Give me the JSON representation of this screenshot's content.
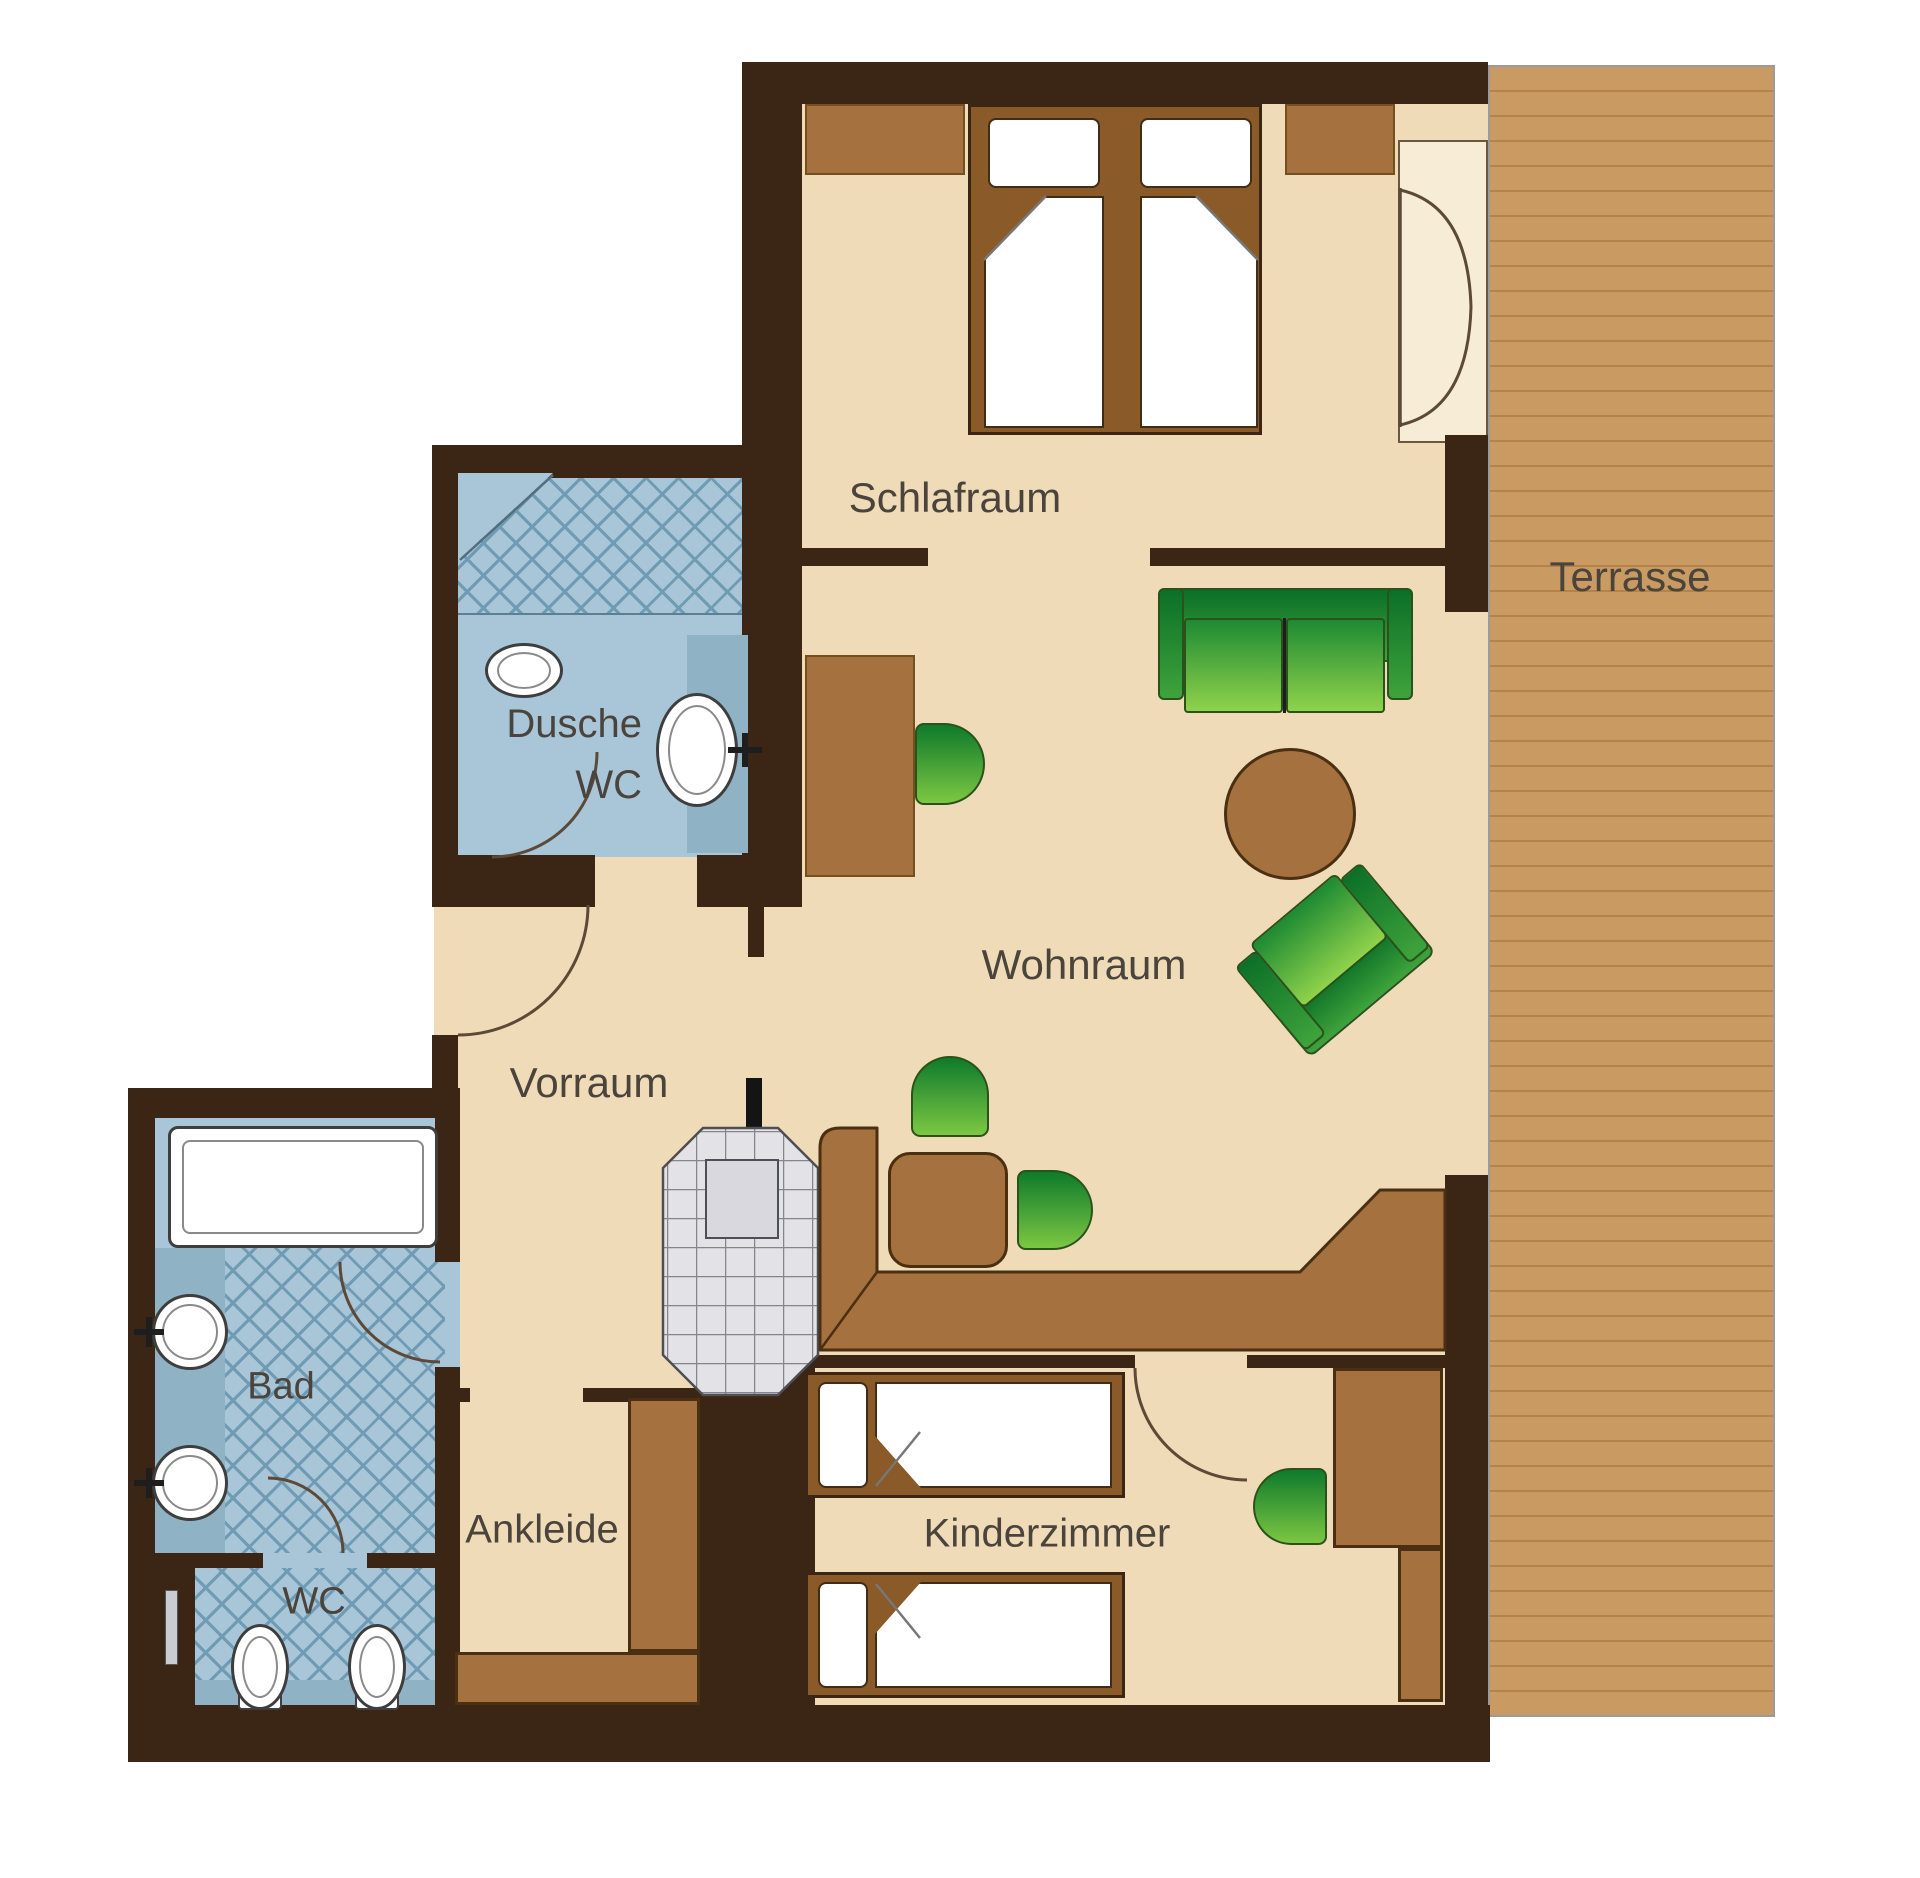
{
  "plan": {
    "type": "apartment-floor-plan",
    "labels": {
      "schlafraum": "Schlafraum",
      "terrasse": "Terrasse",
      "wohnraum": "Wohnraum",
      "vorraum": "Vorraum",
      "dusche": "Dusche",
      "dusche_wc": "WC",
      "bad": "Bad",
      "wc": "WC",
      "ankleide": "Ankleide",
      "kinderzimmer": "Kinderzimmer"
    },
    "colors": {
      "wall": "#3b2616",
      "floor": "#efdbb7",
      "floor_light": "#f7edd6",
      "terrace": "#c99b62",
      "terrace_line": "#b2834a",
      "tile": "#a9c6d8",
      "tile_dark": "#8fb3c5",
      "hatch": "#6f9cb4",
      "furn": "#a4713f",
      "furn_dark": "#8a5a28",
      "green_dark": "#0e7a2c",
      "green_light": "#7cc742",
      "outline": "#4a2f12",
      "text": "#4a443c"
    }
  }
}
